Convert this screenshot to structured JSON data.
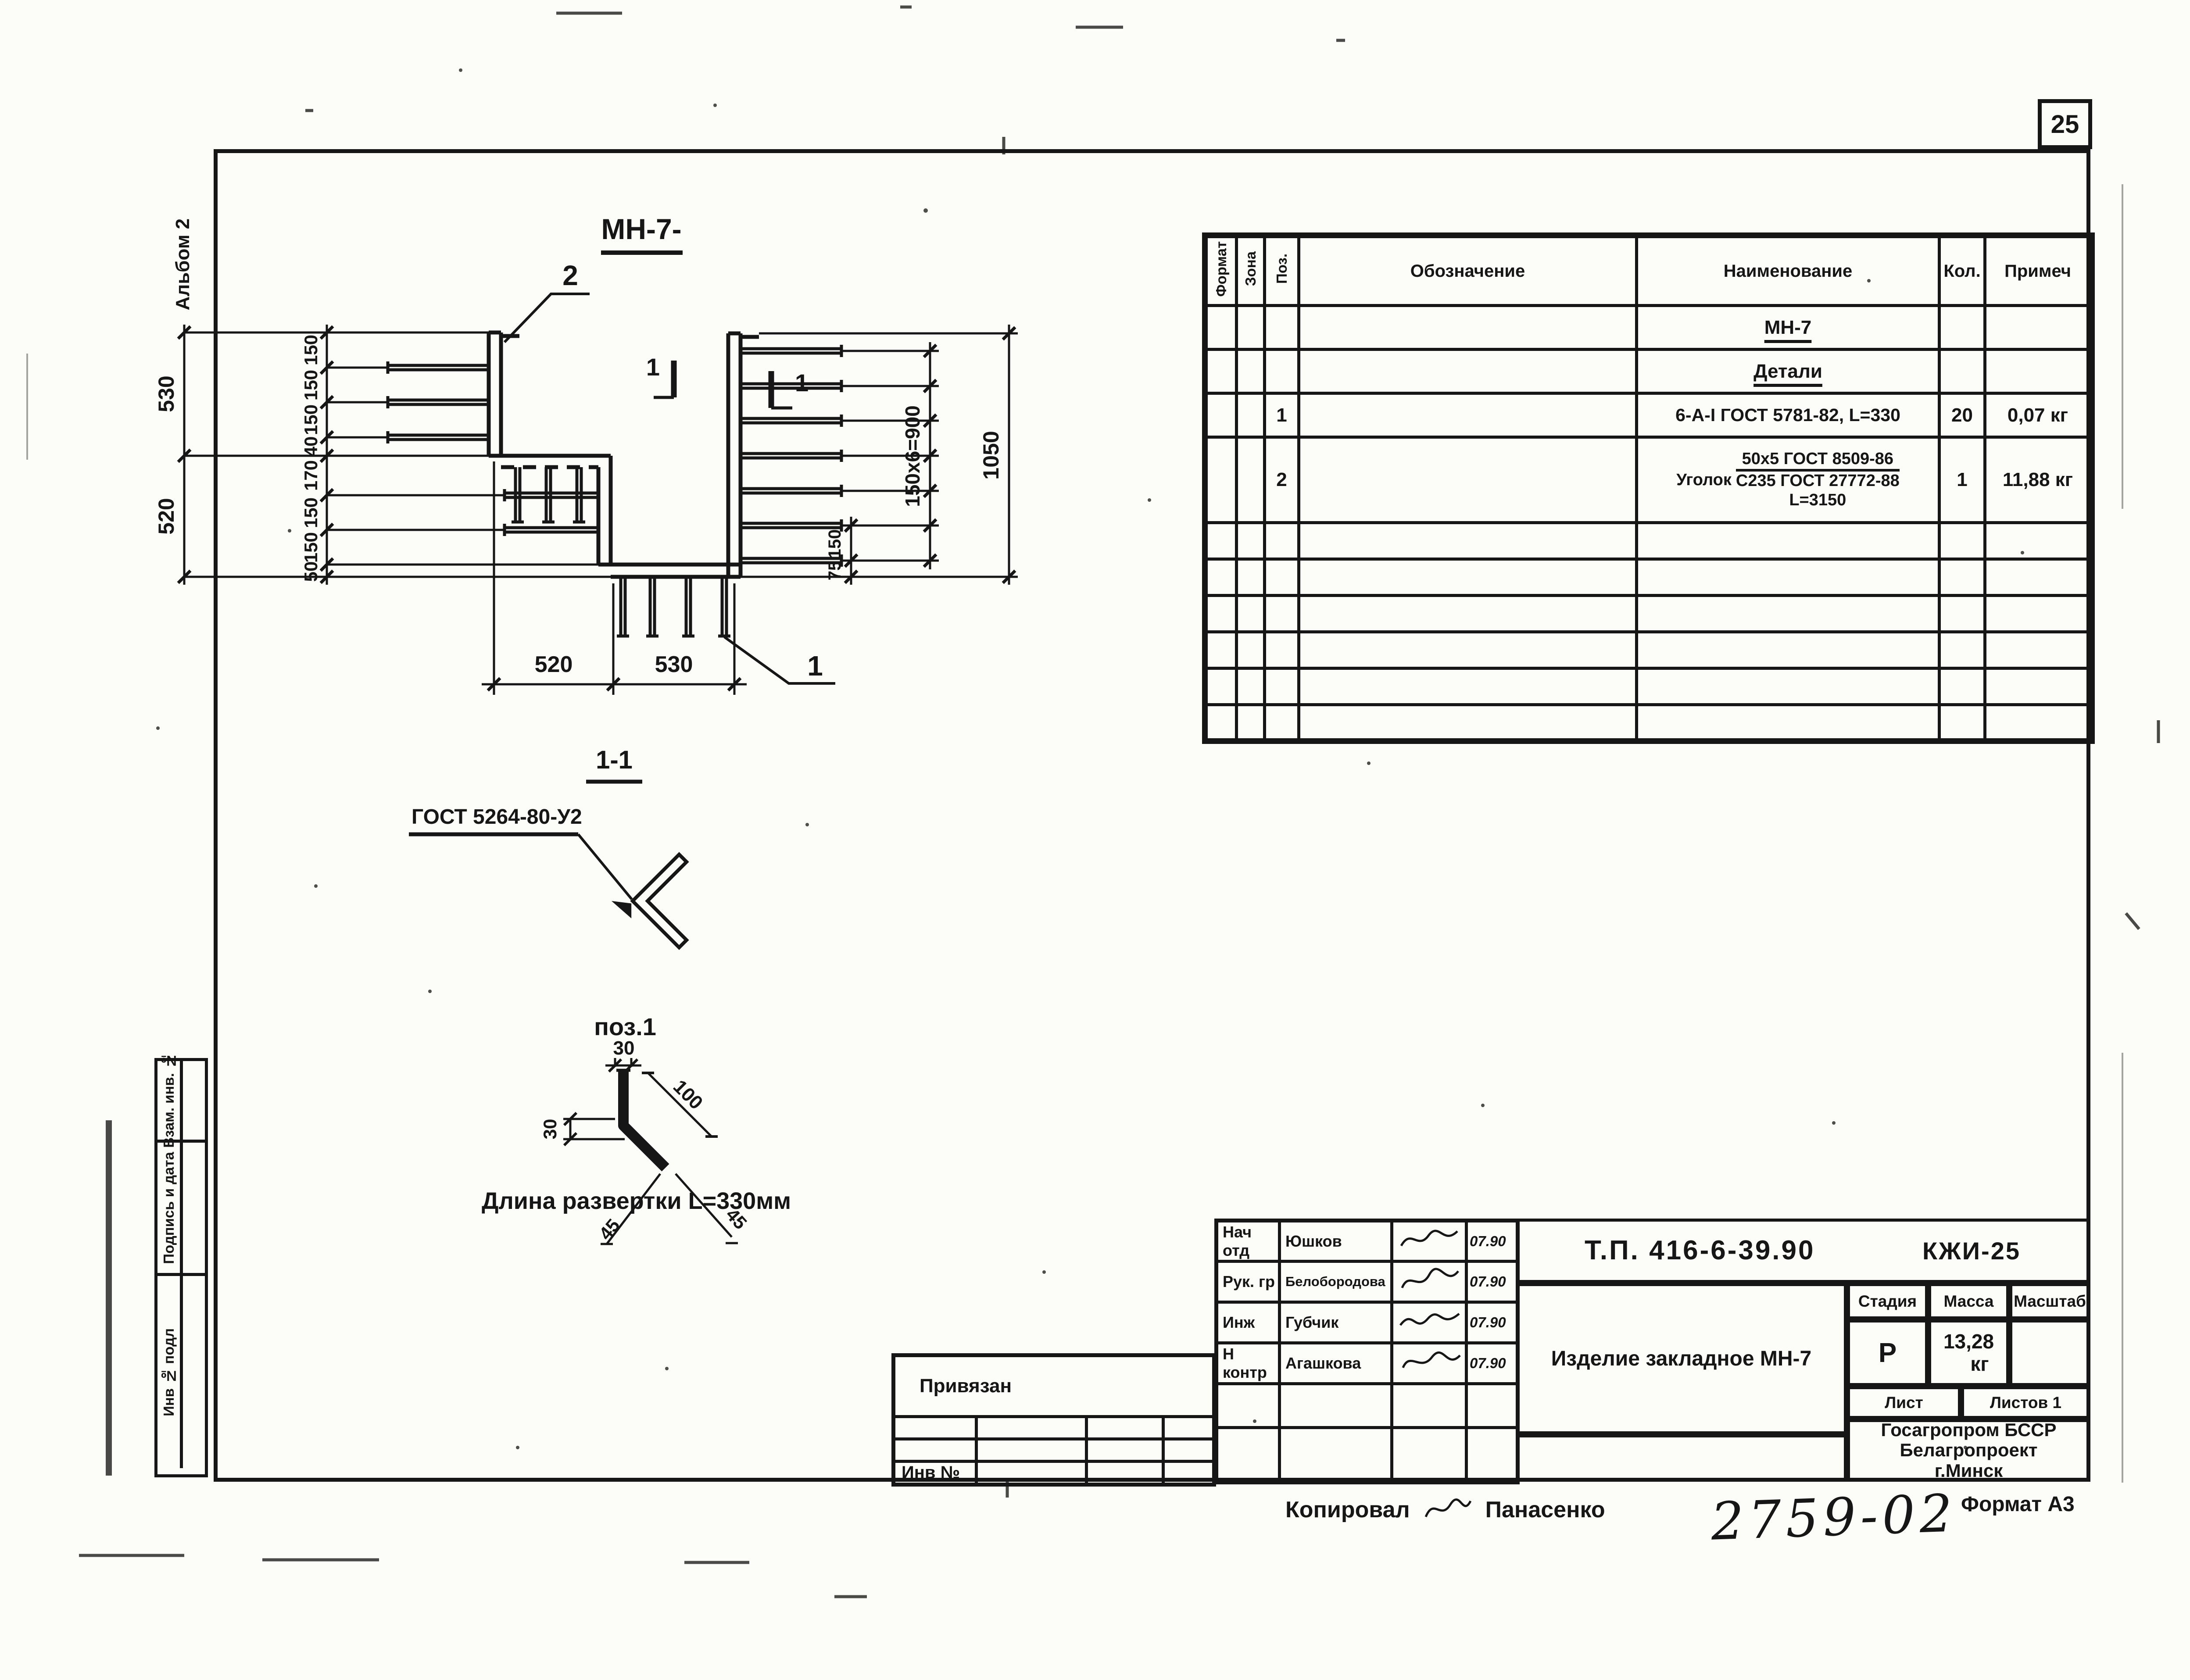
{
  "colors": {
    "ink": "#161616",
    "paper": "#fcfcf9"
  },
  "page": {
    "sheet_no": "25",
    "album": "Альбом 2",
    "format": "Формат А3",
    "doc_no": "2759-02",
    "copied_label": "Копировал",
    "copied_by": "Панасенко"
  },
  "margin": {
    "rows": [
      "Взам. инв. №",
      "Подпись и дата",
      "Инв № подл"
    ]
  },
  "drawing": {
    "title": "МН-7-",
    "callout_top": "2",
    "callout_bottom": "1",
    "section_mark": "1",
    "section_title": "1-1",
    "weld_note": "ГОСТ 5264-80-У2",
    "dim_530": "530",
    "dim_520": "520",
    "dim_b520": "520",
    "dim_b530": "530",
    "left_chain": [
      "150",
      "150",
      "150",
      "40",
      "170",
      "150",
      "150",
      "50"
    ],
    "dim_right_spacing": "150х6=900",
    "dim_right_total": "1050",
    "dim_r150": "150",
    "dim_r75": "75",
    "pos_detail": {
      "label": "поз.1",
      "dim_top": "30",
      "dim_left": "30",
      "dim_diag": "100",
      "angle_left": "45",
      "angle_right": "45",
      "note": "Длина развертки   L=330мм"
    }
  },
  "spec": {
    "headers": {
      "format": "Формат",
      "zone": "Зона",
      "pos": "Поз.",
      "designation": "Обозначение",
      "name": "Наименование",
      "qty": "Кол.",
      "note": "Примеч"
    },
    "group1": "МН-7",
    "group2": "Детали",
    "row1": {
      "pos": "1",
      "name": "6-А-I ГОСТ 5781-82, L=330",
      "qty": "20",
      "note": "0,07 кг"
    },
    "row2": {
      "pos": "2",
      "prefix": "Уголок",
      "num": "50х5 ГОСТ 8509-86",
      "den": "С235 ГОСТ 27772-88",
      "len": "L=3150",
      "qty": "1",
      "note": "11,88 кг"
    }
  },
  "titleblock": {
    "doc_code": "Т.П. 416-6-39.90",
    "series": "КЖИ-25",
    "product": "Изделие закладное МН-7",
    "stage_h": "Стадия",
    "mass_h": "Масса",
    "scale_h": "Масштаб",
    "stage": "Р",
    "mass_val": "13,28",
    "mass_unit": "кг",
    "sheet_h": "Лист",
    "sheets_h": "Листов 1",
    "org1": "Госагропром БССР",
    "org2": "Белагропроект",
    "org3": "г.Минск",
    "signs": [
      {
        "role": "Нач отд",
        "name": "Юшков",
        "date": "07.90"
      },
      {
        "role": "Рук. гр",
        "name": "Белобородова",
        "date": "07.90"
      },
      {
        "role": "Инж",
        "name": "Губчик",
        "date": "07.90"
      },
      {
        "role": "Н контр",
        "name": "Агашкова",
        "date": "07.90"
      }
    ]
  },
  "aux": {
    "title": "Привязан",
    "inv": "Инв №"
  }
}
